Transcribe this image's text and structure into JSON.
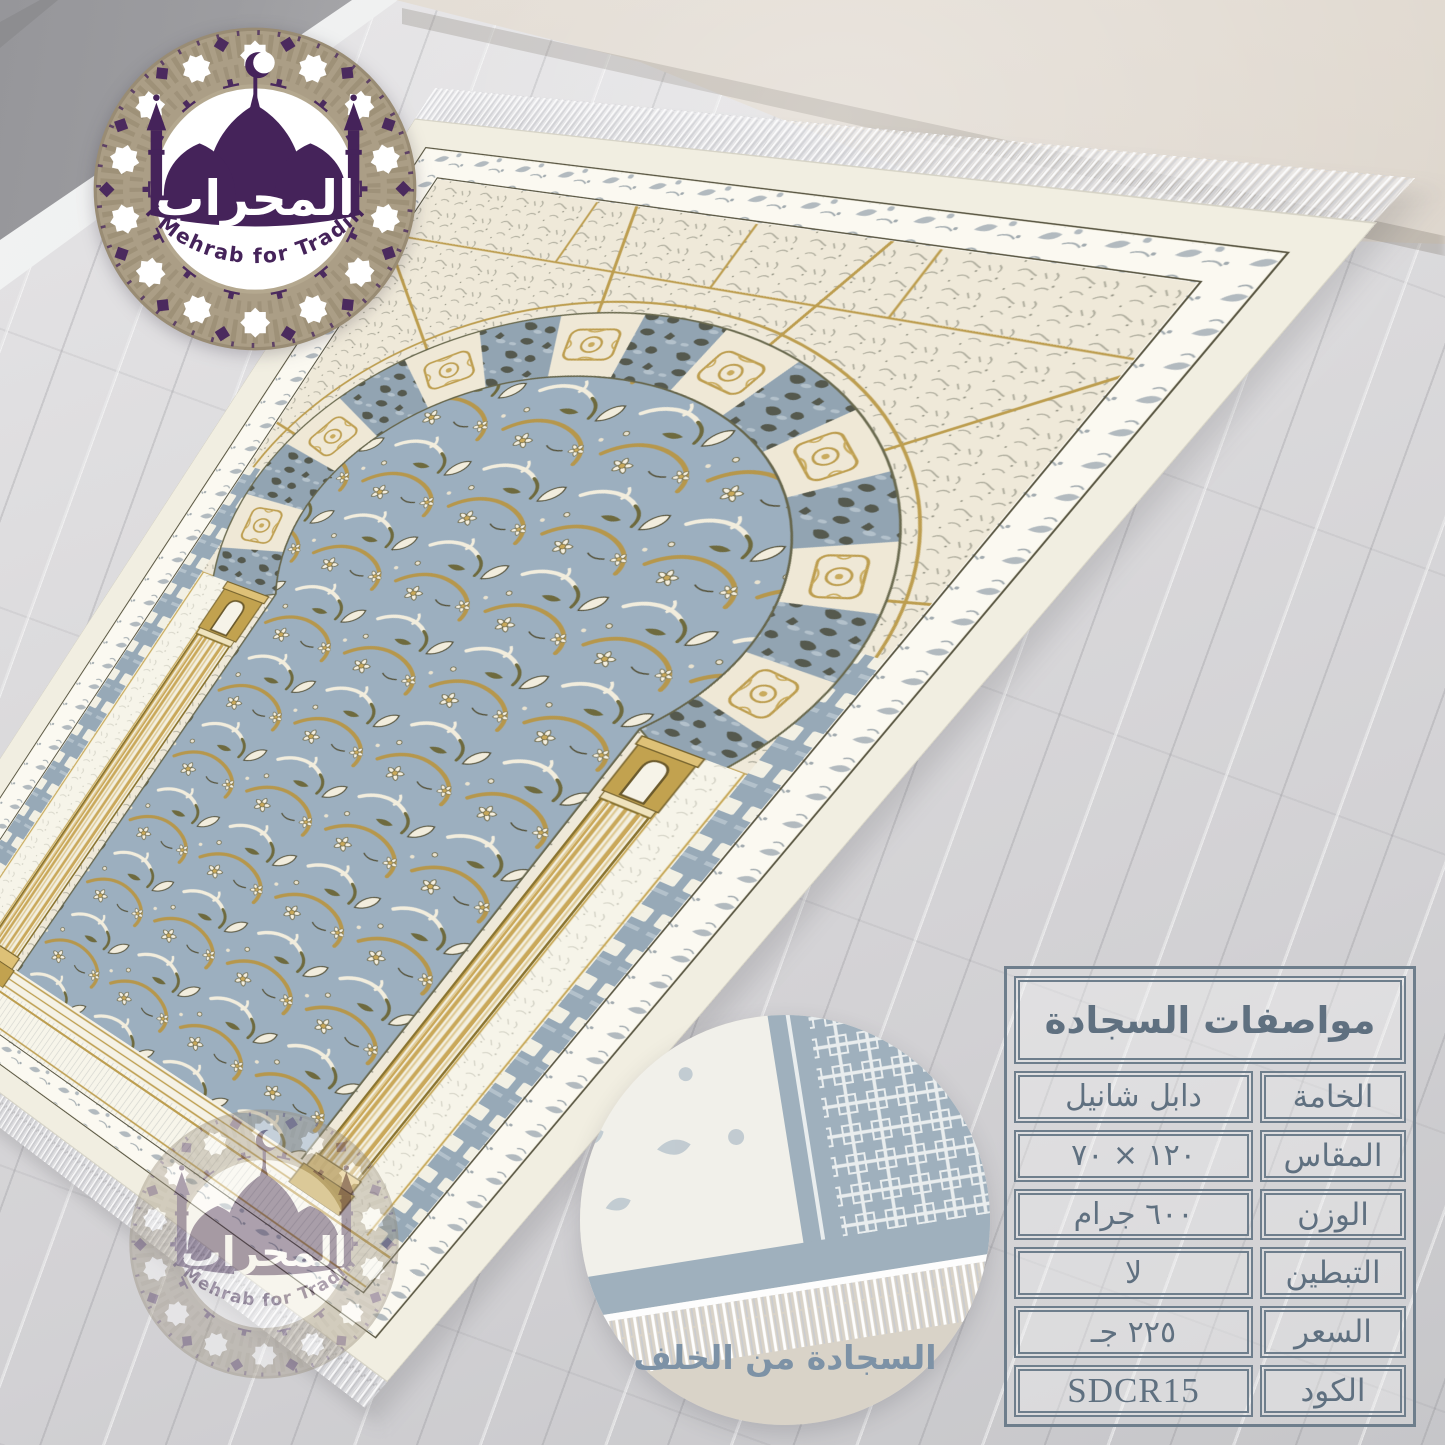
{
  "brand": {
    "logo_arabic": "المحراب",
    "logo_latin": "Al Mehrab for Trading"
  },
  "inset": {
    "caption": "السجادة من الخلف"
  },
  "spec_table": {
    "title": "مواصفات السجادة",
    "rows": [
      {
        "label": "الخامة",
        "value": "دابل شانيل"
      },
      {
        "label": "المقاس",
        "value": "١٢٠ × ٧٠"
      },
      {
        "label": "الوزن",
        "value": "٦٠٠ جرام"
      },
      {
        "label": "التبطين",
        "value": "لا"
      },
      {
        "label": "السعر",
        "value": "٢٢٥ جـ"
      },
      {
        "label": "الكود",
        "value": "SDCR15"
      }
    ]
  },
  "colors": {
    "purple": "#45235a",
    "ring_tan": "#ab9e86",
    "slate_border": "#6e7e8c",
    "slate_text": "#5f7080",
    "caption_text": "#7d92a6",
    "gold": "#bd9e50",
    "field_blue": "#9cafbf",
    "cream": "#f1eee1",
    "wall_gray": "#a8a8aa",
    "wall_beige": "#d7cfc5",
    "floor_gray": "#d8d7d9"
  }
}
